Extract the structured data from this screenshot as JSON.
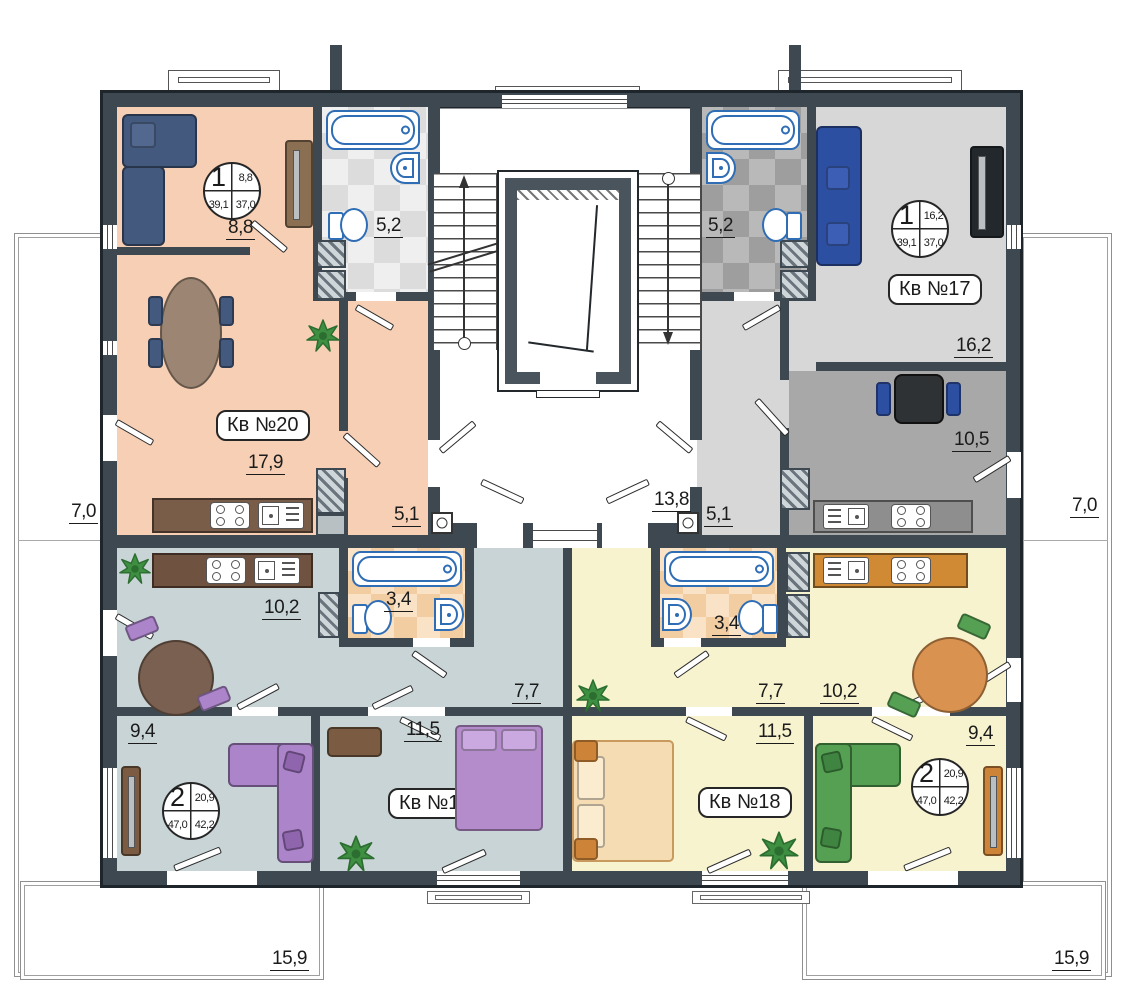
{
  "title": "Floor plan — apartments 17–20",
  "apartments": {
    "kv20": {
      "tag": "Кв №20",
      "info": {
        "rooms": "1",
        "room_area": "8,8",
        "total_area": "39,1",
        "living_area": "37,0"
      },
      "areas": {
        "room": "8,8",
        "bathroom": "5,2",
        "living_kitchen": "17,9",
        "hallway": "5,1"
      }
    },
    "kv17": {
      "tag": "Кв №17",
      "info": {
        "rooms": "1",
        "room_area": "16,2",
        "total_area": "39,1",
        "living_area": "37,0"
      },
      "areas": {
        "bathroom": "5,2",
        "living": "16,2",
        "kitchen": "10,5",
        "hallway": "5,1"
      }
    },
    "kv19": {
      "tag": "Кв №19",
      "info": {
        "rooms": "2",
        "room_area": "20,9",
        "total_area": "47,0",
        "living_area": "42,2"
      },
      "areas": {
        "kitchen": "10,2",
        "bathroom": "3,4",
        "hallway": "7,7",
        "bedroom1": "9,4",
        "bedroom2": "11,5"
      }
    },
    "kv18": {
      "tag": "Кв №18",
      "info": {
        "rooms": "2",
        "room_area": "20,9",
        "total_area": "47,0",
        "living_area": "42,2"
      },
      "areas": {
        "kitchen": "10,2",
        "bathroom": "3,4",
        "hallway": "7,7",
        "bedroom1": "9,4",
        "bedroom2": "11,5"
      }
    }
  },
  "common": {
    "stair_landing": "13,8",
    "balcony_left": "7,0",
    "balcony_right": "7,0",
    "terrace_left": "15,9",
    "terrace_right": "15,9"
  },
  "colors": {
    "wall": "#3d4850",
    "wall_dark": "#1f262b",
    "kv20_floor": "#f6cfb4",
    "kv17_floor": "#d7d7d7",
    "kv17_kitchen": "#a8a8a8",
    "kv19_floor": "#c9d4d6",
    "kv18_floor": "#f8f3cf",
    "fixture_blue": "#2f6db5",
    "counter_brown": "#6f523f",
    "counter_brown_light": "#7a5d49",
    "counter_orange": "#cf8a33",
    "counter_gray": "#8e8e8e",
    "sofa_navy": "#44597e",
    "sofa_royal": "#2d4fa1",
    "purple": "#ab84c9",
    "purple_dark": "#8f66ad",
    "green_sofa": "#55a052",
    "bed_tan": "#f6dcb2",
    "bed_purple": "#b48ccb",
    "table_brown": "#9c8572",
    "table_dark_brown": "#7a6050",
    "plant_green": "#3e8f41"
  }
}
